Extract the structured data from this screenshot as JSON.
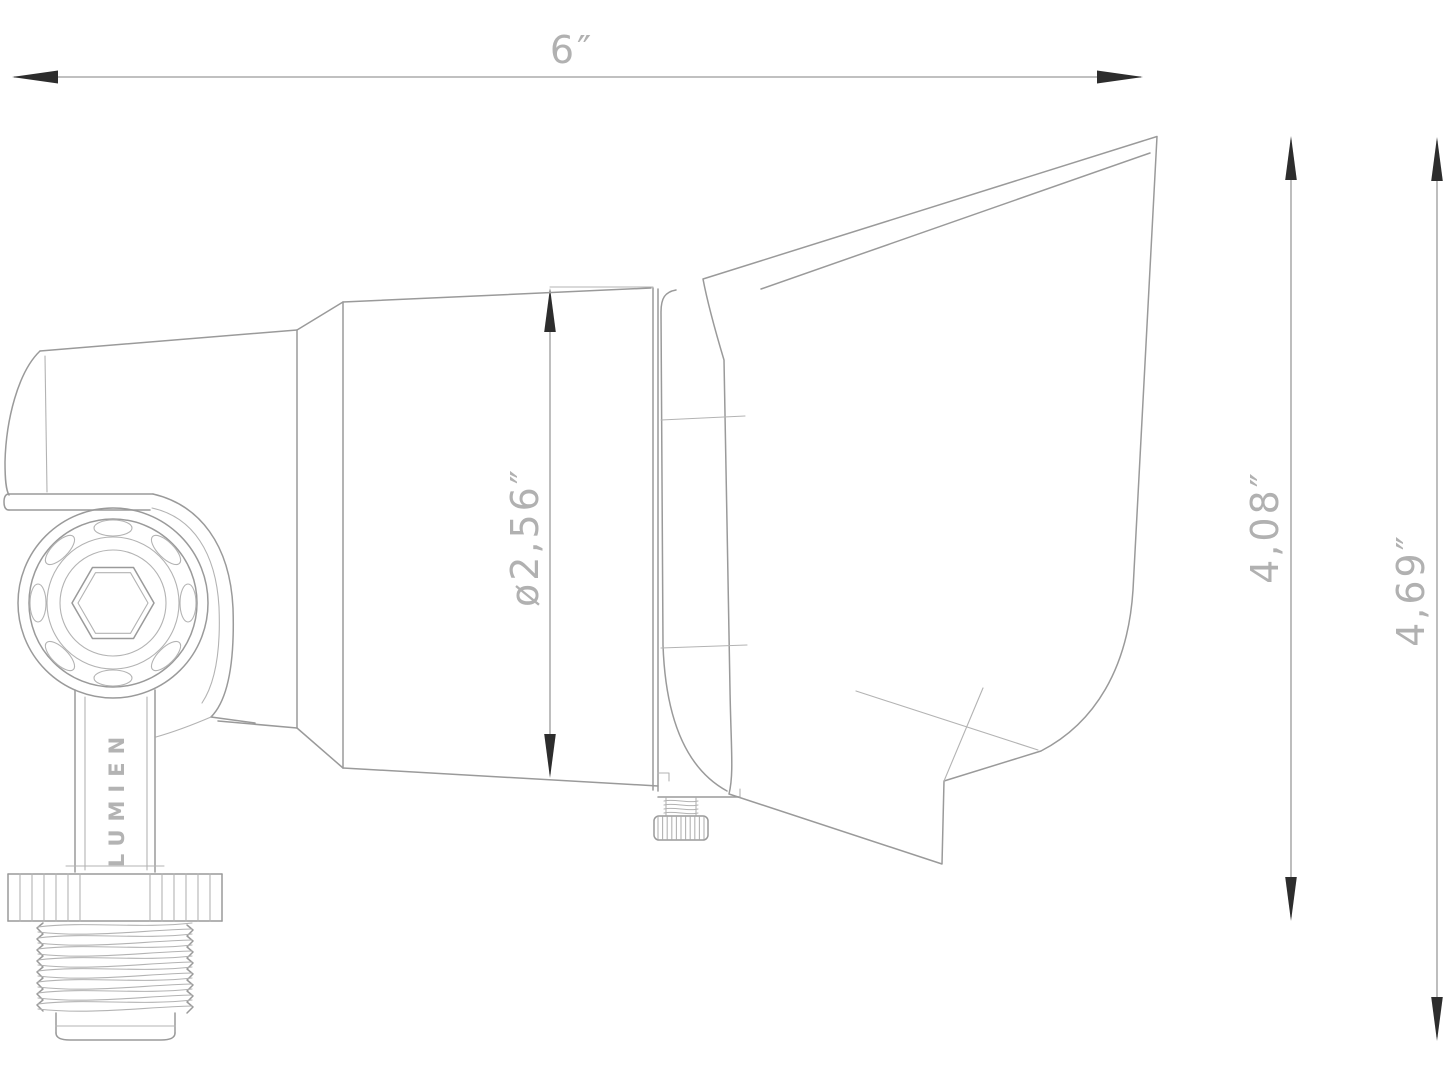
{
  "drawing": {
    "view": "side-view technical line drawing of a directional landscape flood light with dimension callouts",
    "brand": "LUMIEN",
    "colors": {
      "background": "#ffffff",
      "line": "#9a9a9a",
      "thin_line": "#b3b3b3",
      "arrowhead": "#2d2d2d",
      "label_text": "#b1b1b1"
    },
    "dimensions": [
      {
        "name": "overall-length",
        "label": "6″",
        "value": 6,
        "unit": "in",
        "orientation": "horizontal"
      },
      {
        "name": "body-diameter",
        "label": "ø2,56″",
        "value": 2.56,
        "unit": "in",
        "orientation": "vertical"
      },
      {
        "name": "height-to-hood-top",
        "label": "4,08″",
        "value": 4.08,
        "unit": "in",
        "orientation": "vertical"
      },
      {
        "name": "overall-height",
        "label": "4,69″",
        "value": 4.69,
        "unit": "in",
        "orientation": "vertical"
      }
    ]
  },
  "labels": {
    "width": "6″",
    "diameter": "ø2,56″",
    "height_inner": "4,08″",
    "height_overall": "4,69″",
    "brand": "LUMIEN"
  }
}
